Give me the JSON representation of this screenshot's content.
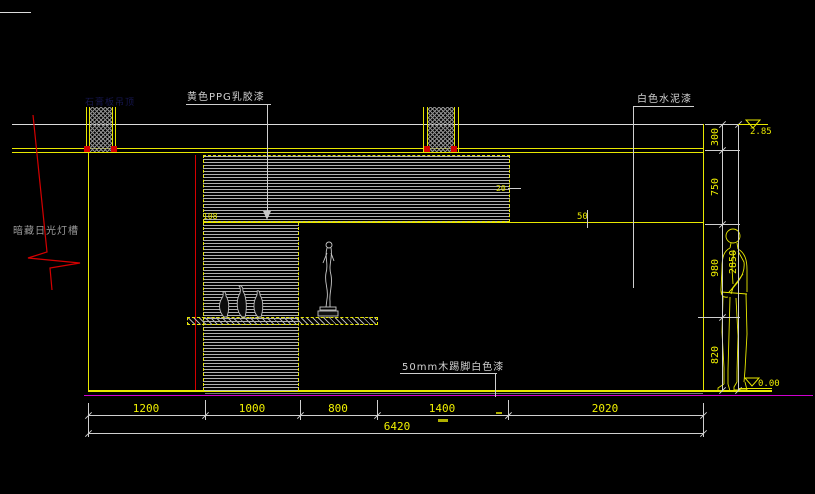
{
  "drawing": {
    "type": "CAD interior elevation, black model-space background",
    "annotations": {
      "ceiling_paint": "黄色PPG乳胶漆",
      "wall_paint": "白色水泥漆",
      "skirting": "50mm木踢脚白色漆",
      "light_cove": "暗藏日光灯槽",
      "ceiling_note": "石膏板吊顶",
      "panel_step_dim": "108",
      "panel_edge_dim": "20",
      "ledge_dim": "50",
      "level_top": "2.85",
      "level_floor": "0.00"
    },
    "dimensions": {
      "bottom_row1": [
        "1200",
        "1000",
        "800",
        "1400",
        "2020"
      ],
      "bottom_total": "6420",
      "right_col": [
        "300",
        "750",
        "980",
        "820"
      ],
      "right_total": "2850"
    },
    "colors": {
      "background": "#000000",
      "wall_lines": "#e8e800",
      "dimension_lines": "#cfcfcf",
      "dimension_text": "#f0f000",
      "leader_red": "#d40000",
      "floor_dim_line": "#cf00cf",
      "label_text": "#d0d0d0",
      "ceiling_note_text": "#16164f"
    }
  }
}
